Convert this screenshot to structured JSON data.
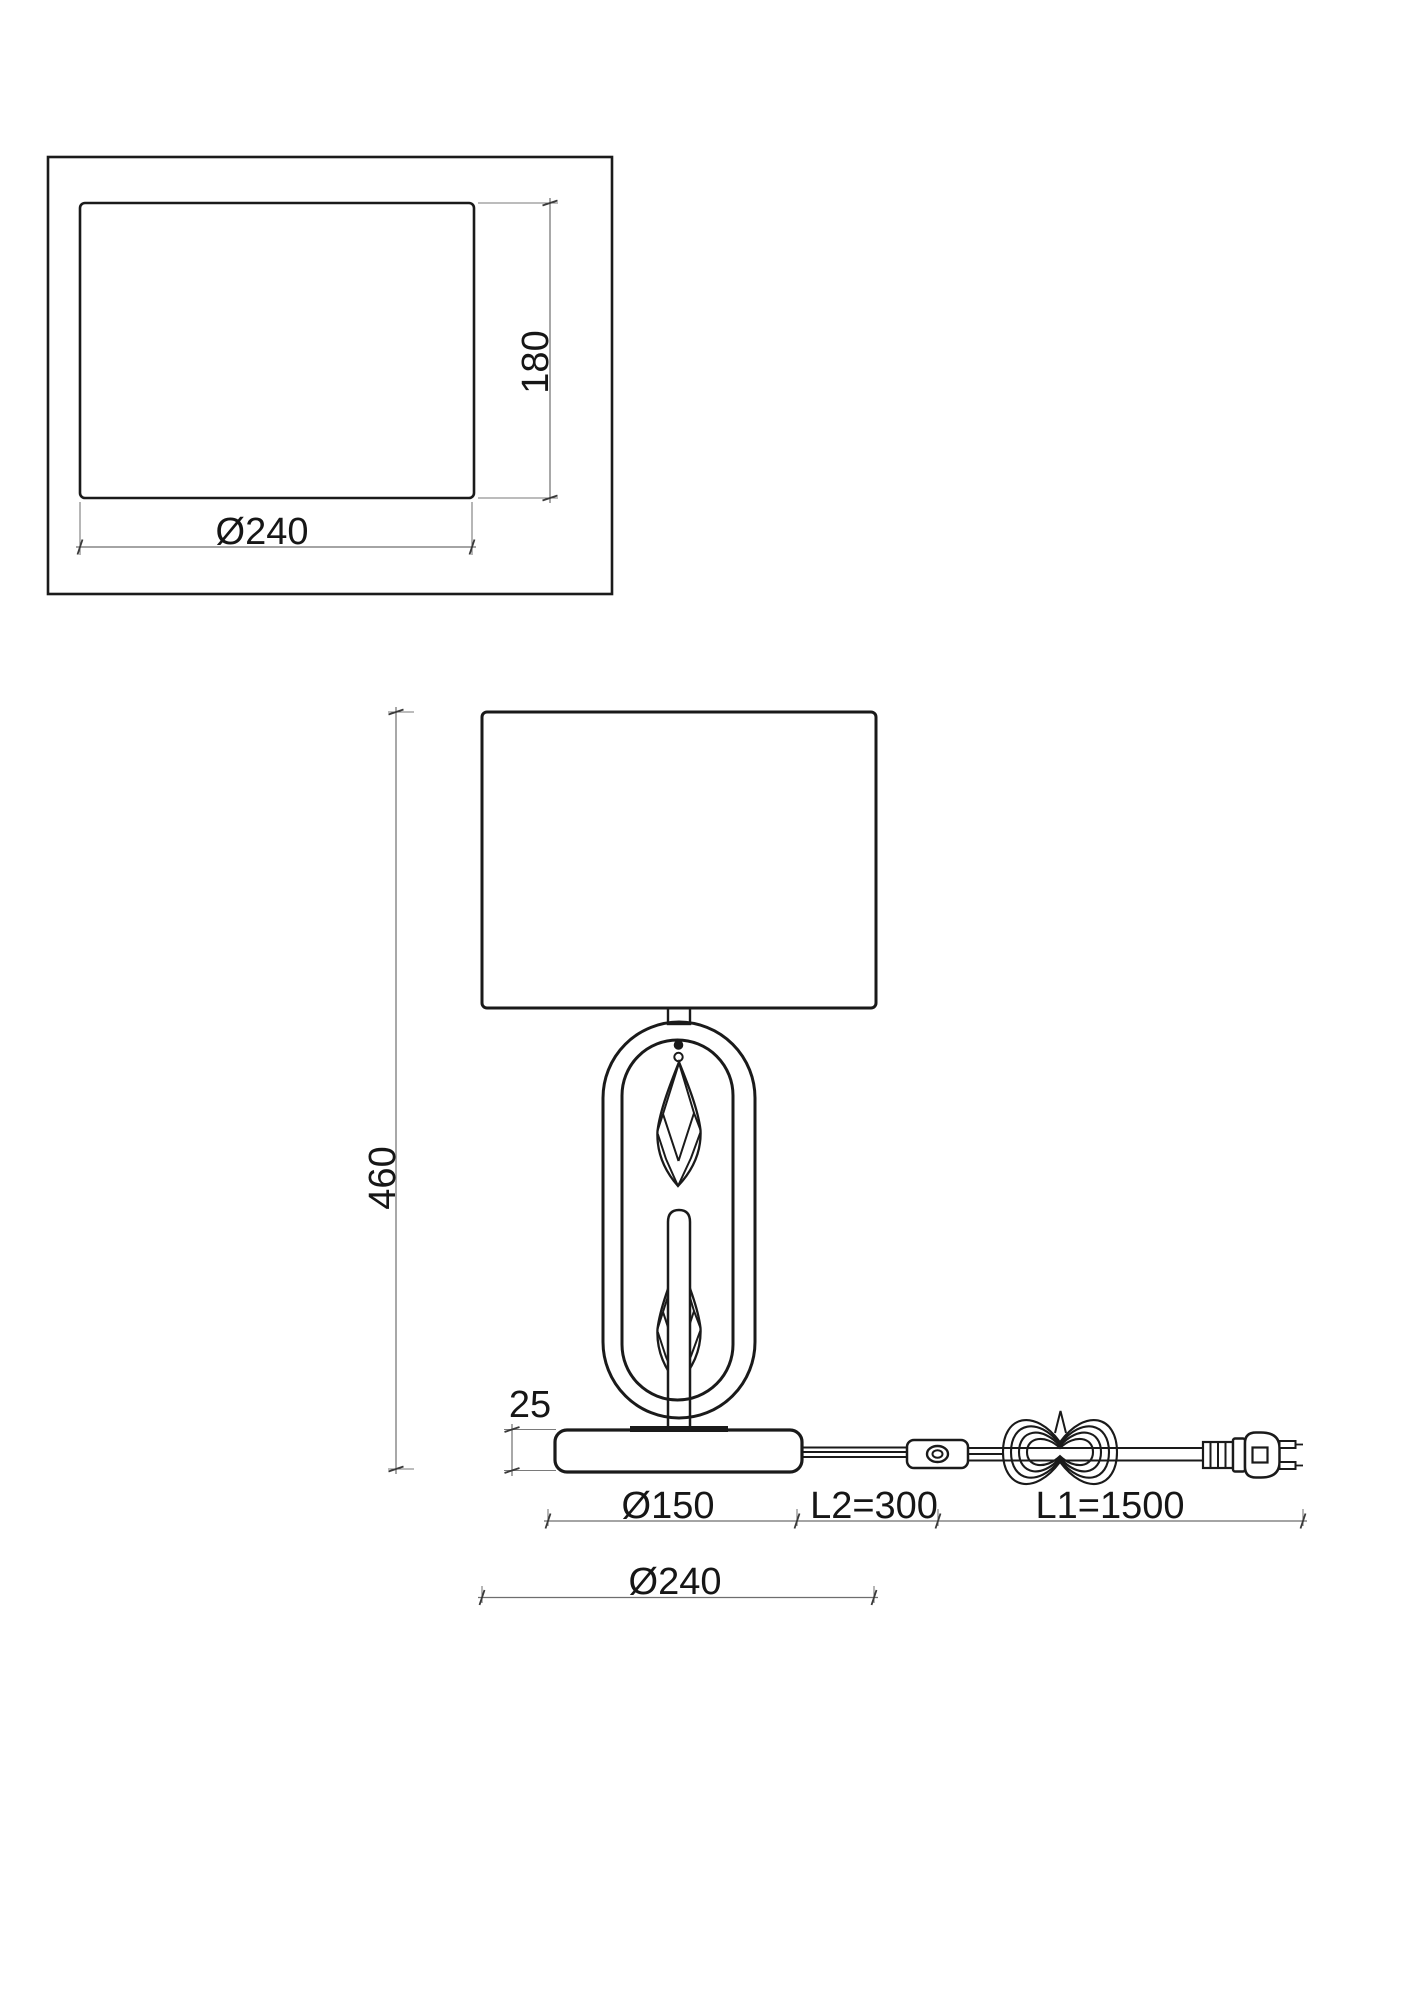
{
  "labels": {
    "top_view": {
      "width": "Ø240",
      "depth": "180"
    },
    "front_view": {
      "total_height": "460",
      "base_thickness": "25",
      "base_diameter": "Ø150",
      "cord_l2": "L2=300",
      "cord_l1": "L1=1500",
      "shade_width": "Ø240"
    }
  },
  "values_mm": {
    "shade_width": 240,
    "shade_depth": 180,
    "total_height": 460,
    "base_thickness": 25,
    "base_diameter": 150,
    "cord_segment_l2": 300,
    "cord_segment_l1": 1500
  },
  "colors": {
    "background": "#ffffff",
    "outline": "#1a1a1a",
    "dimension_line": "#6e6e6e",
    "tick": "#3a3a3a",
    "text": "#161616"
  }
}
